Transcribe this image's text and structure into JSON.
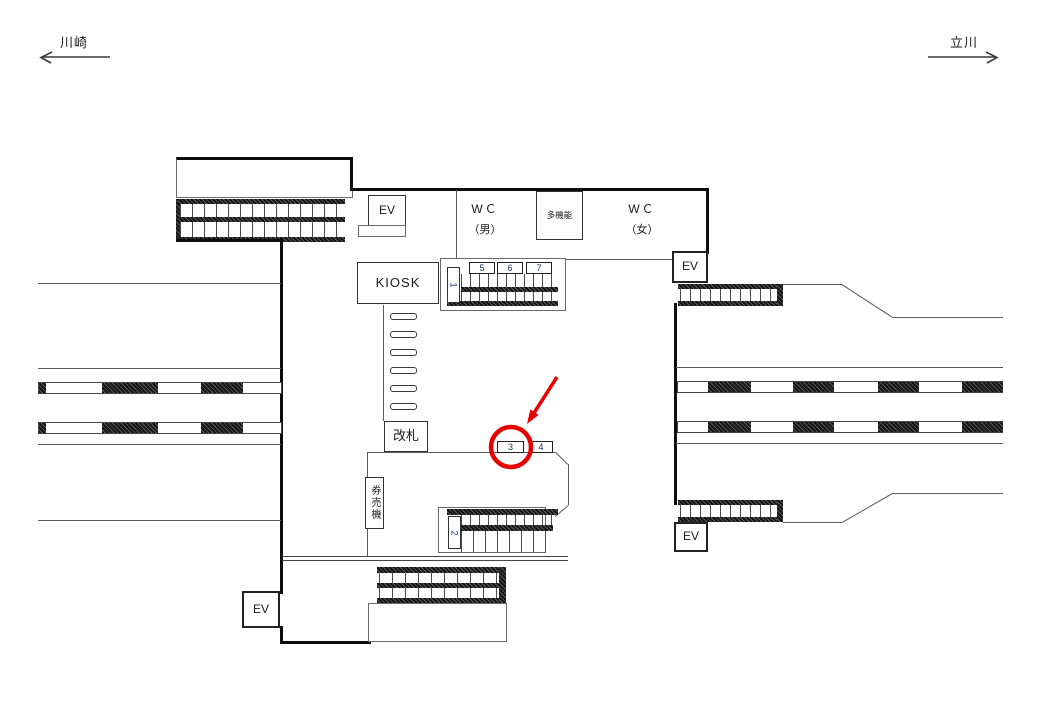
{
  "directions": {
    "left": "川崎",
    "right": "立川"
  },
  "rooms": {
    "ev": "EV",
    "wc_men_line1": "WＣ",
    "wc_men_line2": "（男）",
    "multi_function": "多機能",
    "wc_women_line1": "WＣ",
    "wc_women_line2": "（女）",
    "kiosk": "KIOSK",
    "ticket_gate": "改札",
    "ticket_machines": "券売機"
  },
  "ad_positions": {
    "pos1": "1",
    "pos2": "2",
    "pos3": "3",
    "pos4": "4",
    "pos5": "5",
    "pos6": "6",
    "pos7": "7"
  },
  "annotation": {
    "highlighted_position": "3"
  },
  "colors": {
    "highlight_red": "#e60000",
    "wall": "#0d0d0d",
    "line": "#5a5a5a"
  }
}
